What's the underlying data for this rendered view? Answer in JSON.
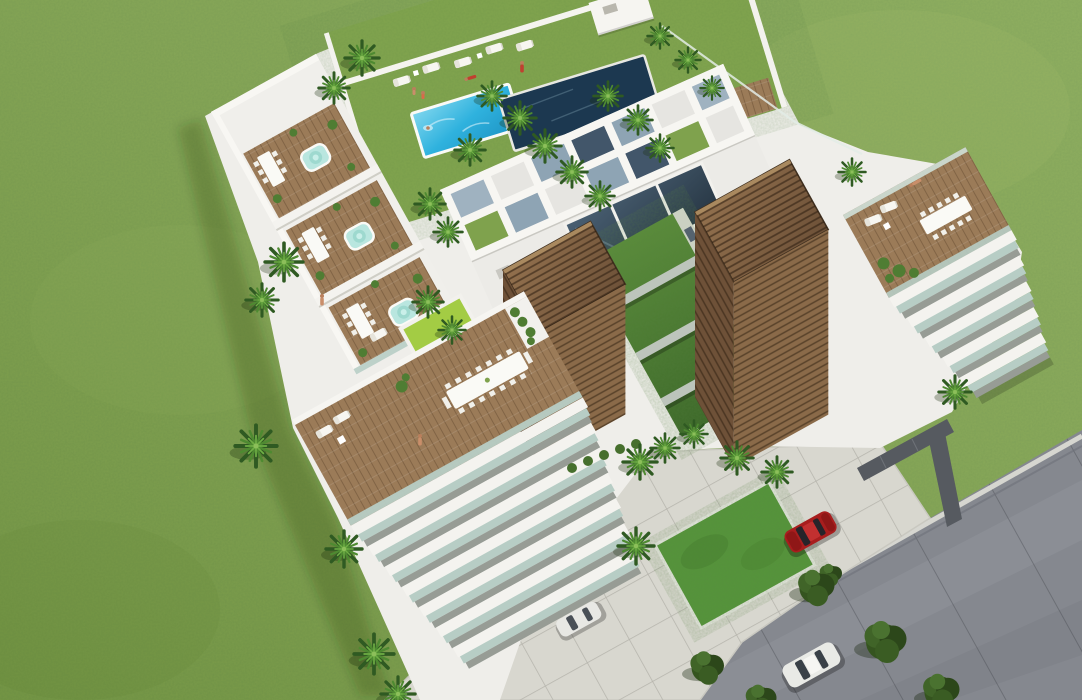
{
  "scene": {
    "type": "aerial-3d-architectural-rendering",
    "subject": "Modern white resort apartment complex with rooftop pool deck, wooden louver towers, vertical garden, terraces, palm trees, lawn and access road",
    "palette": {
      "grass": "#84a74f",
      "deckGrass": "#82a54e",
      "lawn": "#55953a",
      "buildingWhite": "#efeeea",
      "poolBlue": "#2fb2de",
      "poolBlueLight": "#7fd6ee",
      "poolDark": "#1c3850",
      "deckWood": "#9b7b58",
      "towerWood": "#8a6a49",
      "towerWoodShade": "#6e5138",
      "greenWall": "#4e7c33",
      "glassRail": "#b7cdc5",
      "skylightGlass": "#2c3e4d",
      "paving": "#d8d7cf",
      "road": "#85888f",
      "curb": "#d6d6d0",
      "pathDark": "#565a60",
      "palmGreen": "#2f5a22",
      "treeGreen": "#35541f",
      "carRed": "#a81e1e",
      "carWhite": "#e9eae6",
      "skin": "#c98e6a"
    },
    "objects": {
      "pools": [
        "rooftop-swimming-pool",
        "rooftop-lap-pool"
      ],
      "jacuzzis": 3,
      "wooden_louver_towers": 2,
      "vertical_garden_walls": 1,
      "rooftop_terraces": 6,
      "balcony_floors_visible": 12,
      "palm_trees": 32,
      "shade_trees": 6,
      "people": 8,
      "cars": [
        "red-car-driveway",
        "white-car-road",
        "white-car-entrance"
      ],
      "lawn_squares": 1,
      "roads": 1
    }
  }
}
